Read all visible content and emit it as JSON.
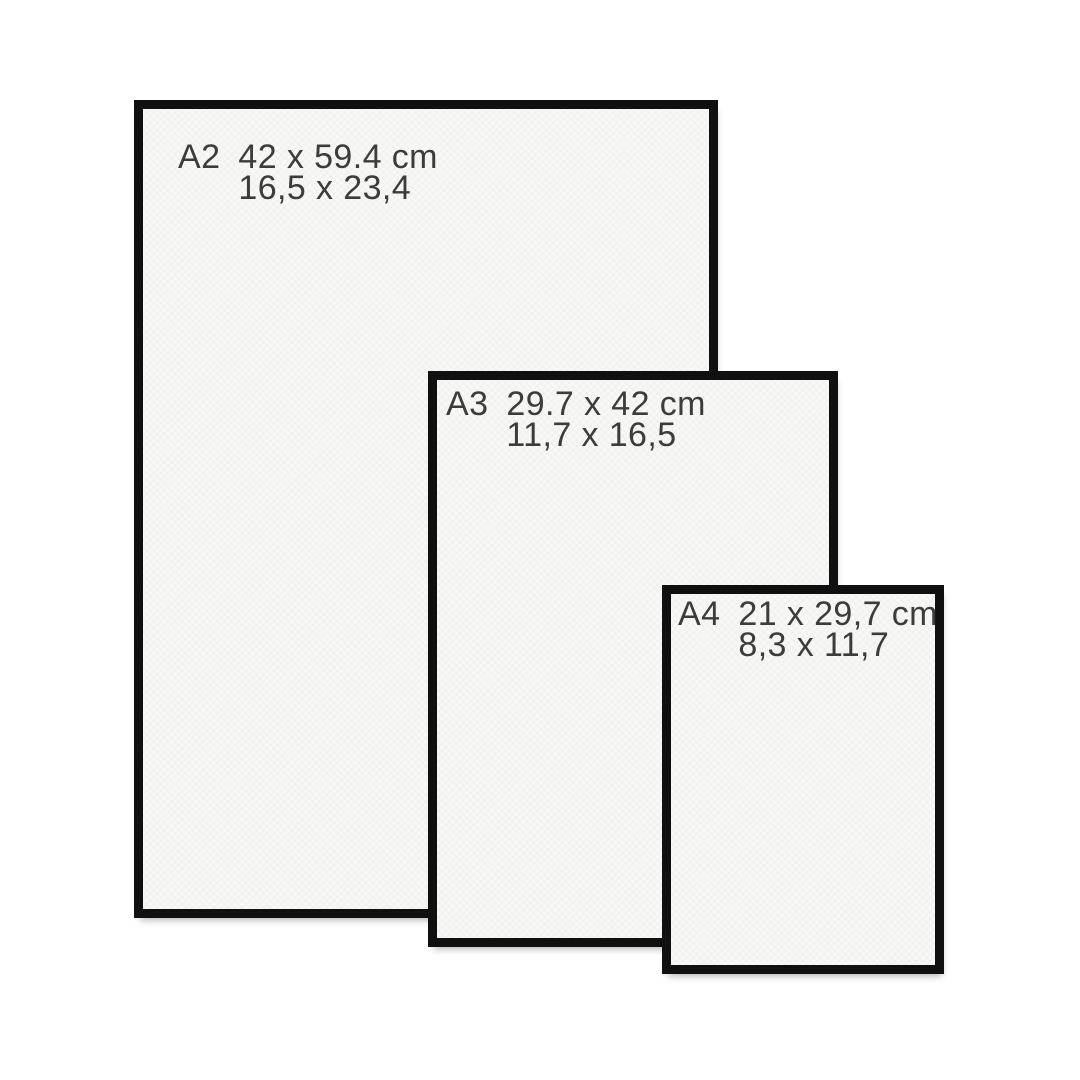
{
  "diagram": {
    "description": "Paper size comparison of framed prints",
    "background_color": "#ffffff",
    "frame_border_color": "#101010",
    "paper_color": "#f8f8f6",
    "text_color": "#3c3c3c"
  },
  "frames": [
    {
      "name": "A2",
      "dimensions_cm": "42 x 59.4 cm",
      "dimensions_inches": "16,5 x 23,4"
    },
    {
      "name": "A3",
      "dimensions_cm": "29.7 x 42 cm",
      "dimensions_inches": "11,7 x 16,5"
    },
    {
      "name": "A4",
      "dimensions_cm": "21 x 29,7 cm",
      "dimensions_inches": "8,3 x 11,7"
    }
  ]
}
